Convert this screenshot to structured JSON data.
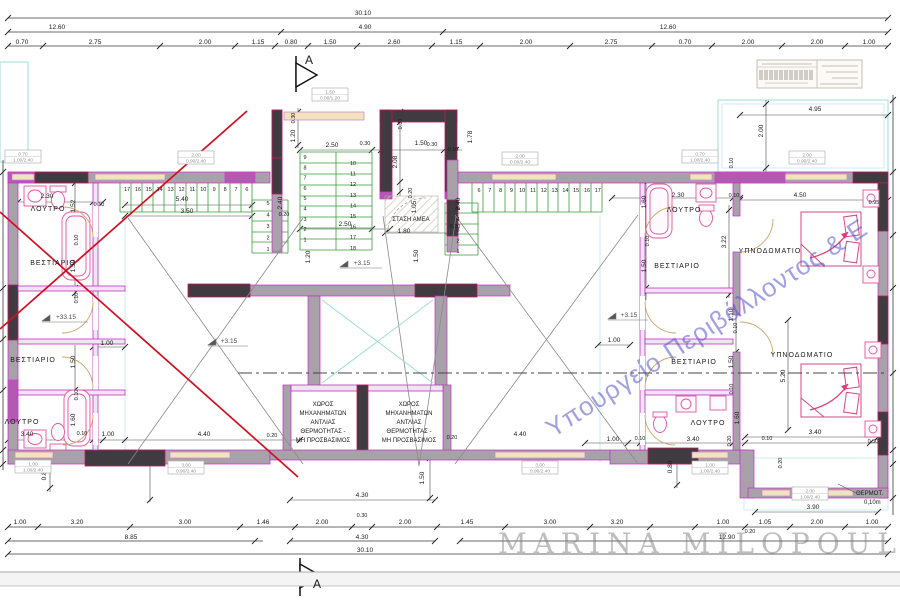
{
  "title": "Architectural floor plan",
  "watermarks": {
    "ministry": "Υπουργείο Περιβάλλοντος & Ε",
    "author": "MARINA MILOPOULOU"
  },
  "section_marker_letter": "A",
  "colors": {
    "wall_magenta": "#c92ac9",
    "wall_dark": "#3f3b40",
    "stair_green": "#3a9e3a",
    "revision_red": "#d40f1f",
    "balcony_cyan": "#9fdbdb",
    "window_tan": "#f3e2c0",
    "fixture_pink": "#e0559f",
    "watermark_blue": "#5252d0"
  },
  "labels": [
    {
      "n": "dim-overall-top",
      "t": "30.10",
      "x": 363,
      "y": 15
    },
    {
      "n": "dim-label",
      "t": "12.60",
      "x": 57,
      "y": 29
    },
    {
      "n": "dim-label",
      "t": "4.90",
      "x": 365,
      "y": 29
    },
    {
      "n": "dim-label",
      "t": "12.60",
      "x": 668,
      "y": 29
    },
    {
      "n": "dim-label",
      "t": "0.70",
      "x": 22,
      "y": 44
    },
    {
      "n": "dim-label",
      "t": "2.75",
      "x": 95,
      "y": 44
    },
    {
      "n": "dim-label",
      "t": "2.00",
      "x": 205,
      "y": 44
    },
    {
      "n": "dim-label",
      "t": "1.15",
      "x": 258,
      "y": 44
    },
    {
      "n": "dim-label",
      "t": "0.80",
      "x": 291,
      "y": 44
    },
    {
      "n": "dim-label",
      "t": "1.50",
      "x": 330,
      "y": 44
    },
    {
      "n": "dim-label",
      "t": "2.60",
      "x": 394,
      "y": 44
    },
    {
      "n": "dim-label",
      "t": "1.15",
      "x": 456,
      "y": 44
    },
    {
      "n": "dim-label",
      "t": "2.00",
      "x": 526,
      "y": 44
    },
    {
      "n": "dim-label",
      "t": "2.75",
      "x": 611,
      "y": 44
    },
    {
      "n": "dim-label",
      "t": "0.70",
      "x": 685,
      "y": 44
    },
    {
      "n": "dim-label",
      "t": "2.00",
      "x": 748,
      "y": 44
    },
    {
      "n": "dim-label",
      "t": "2.00",
      "x": 817,
      "y": 44
    },
    {
      "n": "dim-label",
      "t": "1.00",
      "x": 869,
      "y": 44
    },
    {
      "n": "dim-label",
      "t": "1.00",
      "x": 20,
      "y": 524
    },
    {
      "n": "dim-label",
      "t": "3.20",
      "x": 77,
      "y": 524
    },
    {
      "n": "dim-label",
      "t": "3.00",
      "x": 185,
      "y": 524
    },
    {
      "n": "dim-label",
      "t": "1.46",
      "x": 263,
      "y": 524
    },
    {
      "n": "dim-label",
      "t": "2.00",
      "x": 322,
      "y": 524
    },
    {
      "n": "dim-label",
      "t": "0.30",
      "x": 362,
      "y": 517,
      "s": 5.5
    },
    {
      "n": "dim-label",
      "t": "2.00",
      "x": 405,
      "y": 524
    },
    {
      "n": "dim-label",
      "t": "1.45",
      "x": 467,
      "y": 524
    },
    {
      "n": "dim-label",
      "t": "3.00",
      "x": 550,
      "y": 524
    },
    {
      "n": "dim-label",
      "t": "3.20",
      "x": 617,
      "y": 524
    },
    {
      "n": "dim-label",
      "t": "1.00",
      "x": 723,
      "y": 524
    },
    {
      "n": "dim-label",
      "t": "1.05",
      "x": 765,
      "y": 524
    },
    {
      "n": "dim-label",
      "t": "0.20",
      "x": 750,
      "y": 533,
      "s": 5.5
    },
    {
      "n": "dim-label",
      "t": "2.00",
      "x": 817,
      "y": 524
    },
    {
      "n": "dim-label",
      "t": "1.00",
      "x": 872,
      "y": 524
    },
    {
      "n": "dim-label",
      "t": "8.85",
      "x": 131,
      "y": 539
    },
    {
      "n": "dim-label",
      "t": "4.30",
      "x": 362,
      "y": 539
    },
    {
      "n": "dim-label",
      "t": "12.90",
      "x": 727,
      "y": 539
    },
    {
      "n": "dim-overall-bottom",
      "t": "30.10",
      "x": 365,
      "y": 552
    },
    {
      "n": "dim-label",
      "t": "4.30",
      "x": 362,
      "y": 497
    },
    {
      "n": "dim-label",
      "t": "3.90",
      "x": 813,
      "y": 509
    },
    {
      "n": "dim-label",
      "t": "1.50",
      "x": 424,
      "y": 478,
      "r": -90
    },
    {
      "n": "dim-label",
      "t": "3.40",
      "x": 27,
      "y": 436
    },
    {
      "n": "dim-label",
      "t": "0.10",
      "x": 82,
      "y": 435,
      "s": 5.5
    },
    {
      "n": "dim-label",
      "t": "1.00",
      "x": 108,
      "y": 436
    },
    {
      "n": "dim-label",
      "t": "4.40",
      "x": 204,
      "y": 436
    },
    {
      "n": "dim-label",
      "t": "0.20",
      "x": 272,
      "y": 437,
      "s": 5.5
    },
    {
      "n": "dim-label",
      "t": "0.20",
      "x": 452,
      "y": 439,
      "s": 5.5
    },
    {
      "n": "dim-label",
      "t": "4.40",
      "x": 520,
      "y": 436
    },
    {
      "n": "dim-label",
      "t": "1.00",
      "x": 613,
      "y": 441
    },
    {
      "n": "dim-label",
      "t": "0.10",
      "x": 640,
      "y": 440,
      "s": 5.5
    },
    {
      "n": "dim-label",
      "t": "3.40",
      "x": 693,
      "y": 441
    },
    {
      "n": "dim-label",
      "t": "0.10",
      "x": 767,
      "y": 440,
      "s": 5.5
    },
    {
      "n": "dim-label",
      "t": "3.40",
      "x": 815,
      "y": 434
    },
    {
      "n": "dim-label",
      "t": "0.30",
      "x": 873,
      "y": 443,
      "s": 5.5
    },
    {
      "n": "dim-label",
      "t": "0.80",
      "x": 46,
      "y": 474,
      "r": -90
    },
    {
      "n": "dim-label",
      "t": "0.80",
      "x": 672,
      "y": 467,
      "r": -90
    },
    {
      "n": "dim-label",
      "t": "0.20",
      "x": 782,
      "y": 463,
      "r": -90,
      "s": 5.5
    },
    {
      "n": "dim-label",
      "t": "2.30",
      "x": 47,
      "y": 198
    },
    {
      "n": "dim-label",
      "t": "0.10",
      "x": 99,
      "y": 206,
      "s": 5.5
    },
    {
      "n": "dim-label",
      "t": "1.52",
      "x": 75,
      "y": 206,
      "r": -90
    },
    {
      "n": "dim-label",
      "t": "0.10",
      "x": 78,
      "y": 240,
      "r": -90,
      "s": 5.5
    },
    {
      "n": "dim-label",
      "t": "1.50",
      "x": 75,
      "y": 266,
      "r": -90
    },
    {
      "n": "dim-label",
      "t": "0.10",
      "x": 78,
      "y": 298,
      "r": -90,
      "s": 5.5
    },
    {
      "n": "dim-label",
      "t": "1.50",
      "x": 75,
      "y": 362,
      "r": -90
    },
    {
      "n": "dim-label",
      "t": "0.10",
      "x": 78,
      "y": 395,
      "r": -90,
      "s": 5.5
    },
    {
      "n": "dim-label",
      "t": "1.60",
      "x": 75,
      "y": 420,
      "r": -90
    },
    {
      "n": "dim-label",
      "t": "1.00",
      "x": 107,
      "y": 345
    },
    {
      "n": "dim-label",
      "t": "2.30",
      "x": 678,
      "y": 197
    },
    {
      "n": "dim-label",
      "t": "0.10",
      "x": 734,
      "y": 197,
      "s": 5.5
    },
    {
      "n": "dim-label",
      "t": "4.50",
      "x": 800,
      "y": 197
    },
    {
      "n": "dim-label",
      "t": "0.95",
      "x": 874,
      "y": 204,
      "s": 5.5
    },
    {
      "n": "dim-label",
      "t": "1.60",
      "x": 646,
      "y": 202,
      "r": -90
    },
    {
      "n": "dim-label",
      "t": "0.10",
      "x": 649,
      "y": 241,
      "r": -90,
      "s": 5.5
    },
    {
      "n": "dim-label",
      "t": "1.50",
      "x": 646,
      "y": 266,
      "r": -90
    },
    {
      "n": "dim-label",
      "t": "3.22",
      "x": 726,
      "y": 242,
      "r": -90
    },
    {
      "n": "dim-label",
      "t": "0.10",
      "x": 733,
      "y": 163,
      "r": -90,
      "s": 5.5
    },
    {
      "n": "dim-label",
      "t": "1.10",
      "x": 733,
      "y": 315,
      "r": -90
    },
    {
      "n": "dim-label",
      "t": "0.10",
      "x": 737,
      "y": 328,
      "r": -90,
      "s": 5.5
    },
    {
      "n": "dim-label",
      "t": "1.50",
      "x": 733,
      "y": 362,
      "r": -90
    },
    {
      "n": "dim-label",
      "t": "0.10",
      "x": 733,
      "y": 389,
      "r": -90,
      "s": 5.5
    },
    {
      "n": "dim-label",
      "t": "1.60",
      "x": 739,
      "y": 418,
      "r": -90
    },
    {
      "n": "dim-label",
      "t": "0.20",
      "x": 731,
      "y": 441,
      "r": -90,
      "s": 5.5
    },
    {
      "n": "dim-label",
      "t": "5.20",
      "x": 785,
      "y": 376,
      "r": -90
    },
    {
      "n": "dim-label",
      "t": "2.00",
      "x": 763,
      "y": 131,
      "r": -90
    },
    {
      "n": "dim-label",
      "t": "1.78",
      "x": 472,
      "y": 137,
      "r": -90
    },
    {
      "n": "dim-label",
      "t": "1.00",
      "x": 614,
      "y": 342
    },
    {
      "n": "dim-label",
      "t": "4.95",
      "x": 815,
      "y": 111
    },
    {
      "n": "dim-label",
      "t": "2.50",
      "x": 332,
      "y": 147
    },
    {
      "n": "dim-label",
      "t": "0.30",
      "x": 365,
      "y": 145,
      "s": 5.5
    },
    {
      "n": "dim-label",
      "t": "1.50",
      "x": 421,
      "y": 145
    },
    {
      "n": "dim-label",
      "t": "0.30",
      "x": 432,
      "y": 146,
      "s": 5.5
    },
    {
      "n": "dim-label",
      "t": "0.10",
      "x": 453,
      "y": 151,
      "s": 5.5
    },
    {
      "n": "dim-label",
      "t": "2.08",
      "x": 397,
      "y": 162,
      "r": -90
    },
    {
      "n": "dim-label",
      "t": "0.30",
      "x": 402,
      "y": 124,
      "r": -90,
      "s": 5.5
    },
    {
      "n": "dim-label",
      "t": "0.30",
      "x": 295,
      "y": 118,
      "r": -90,
      "s": 5.5
    },
    {
      "n": "dim-label",
      "t": "1.20",
      "x": 295,
      "y": 136,
      "r": -90
    },
    {
      "n": "dim-label",
      "t": "0.20",
      "x": 412,
      "y": 193,
      "r": -90,
      "s": 5.5
    },
    {
      "n": "dim-label",
      "t": "1.05",
      "x": 416,
      "y": 207,
      "r": -90
    },
    {
      "n": "dim-label",
      "t": "1.50",
      "x": 418,
      "y": 256,
      "r": -90
    },
    {
      "n": "dim-label",
      "t": "1.20",
      "x": 310,
      "y": 257,
      "r": -90
    },
    {
      "n": "dim-label",
      "t": "2.40",
      "x": 282,
      "y": 203,
      "r": -90
    },
    {
      "n": "dim-label",
      "t": "2.40",
      "x": 460,
      "y": 204,
      "r": -90
    },
    {
      "n": "dim-label",
      "t": "2.50",
      "x": 345,
      "y": 226
    },
    {
      "n": "dim-label",
      "t": "1.80",
      "x": 404,
      "y": 233
    },
    {
      "n": "dim-label",
      "t": "5.40",
      "x": 182,
      "y": 201
    },
    {
      "n": "dim-label",
      "t": "3.50",
      "x": 187,
      "y": 213
    },
    {
      "n": "dim-label",
      "t": "0.20",
      "x": 284,
      "y": 216,
      "s": 5.5
    },
    {
      "n": "dim-label",
      "t": "0.20",
      "x": 455,
      "y": 228,
      "s": 5.5
    },
    {
      "n": "amea-stop-label",
      "t": "ΣΤΑΣΗ ΑΜΕΑ",
      "x": 411,
      "y": 221,
      "s": 6
    },
    {
      "n": "elevation-label",
      "t": "+3.15",
      "x": 362,
      "y": 265,
      "c": "#4a4a4a"
    },
    {
      "n": "elevation-label",
      "t": "+3.15",
      "x": 229,
      "y": 343,
      "c": "#4a4a4a"
    },
    {
      "n": "elevation-label",
      "t": "+3.15",
      "x": 629,
      "y": 317,
      "c": "#4a4a4a"
    },
    {
      "n": "elevation-label",
      "t": "+33.15",
      "x": 66,
      "y": 319,
      "c": "#4a4a4a"
    },
    {
      "n": "room-label",
      "t": "ΛΟΥΤΡΟ",
      "x": 48,
      "y": 211,
      "s": 7,
      "ls": 1
    },
    {
      "n": "room-label",
      "t": "ΒΕΣΤΙΑΡΙΟ",
      "x": 53,
      "y": 265,
      "s": 7,
      "ls": 1
    },
    {
      "n": "room-label",
      "t": "ΒΕΣΤΙΑΡΙΟ",
      "x": 33,
      "y": 362,
      "s": 7,
      "ls": 1
    },
    {
      "n": "room-label",
      "t": "ΛΟΥΤΡΟ",
      "x": 22,
      "y": 424,
      "s": 7,
      "ls": 1
    },
    {
      "n": "room-label",
      "t": "ΛΟΥΤΡΟ",
      "x": 684,
      "y": 212,
      "s": 7,
      "ls": 1
    },
    {
      "n": "room-label",
      "t": "ΒΕΣΤΙΑΡΙΟ",
      "x": 677,
      "y": 268,
      "s": 7,
      "ls": 1
    },
    {
      "n": "room-label",
      "t": "ΒΕΣΤΙΑΡΙΟ",
      "x": 694,
      "y": 364,
      "s": 7,
      "ls": 1
    },
    {
      "n": "room-label",
      "t": "ΛΟΥΤΡΟ",
      "x": 708,
      "y": 425,
      "s": 7,
      "ls": 1
    },
    {
      "n": "room-label",
      "t": "ΥΠΝΟΔΩΜΑΤΙΟ",
      "x": 770,
      "y": 253,
      "s": 7,
      "ls": 1
    },
    {
      "n": "room-label",
      "t": "ΥΠΝΟΔΩΜΑΤΙΟ",
      "x": 802,
      "y": 357,
      "s": 7,
      "ls": 1
    },
    {
      "n": "machine-room-label",
      "t": "ΧΩΡΟΣ",
      "x": 323,
      "y": 406,
      "s": 6
    },
    {
      "n": "machine-room-label",
      "t": "ΜΗΧΑΝΗΜΑΤΩΝ",
      "x": 323,
      "y": 415,
      "s": 6
    },
    {
      "n": "machine-room-label",
      "t": "ΑΝΤΛΙΑΣ",
      "x": 323,
      "y": 424,
      "s": 6
    },
    {
      "n": "machine-room-label",
      "t": "ΘΕΡΜΟΤΗΤΑΣ -",
      "x": 323,
      "y": 433,
      "s": 6
    },
    {
      "n": "machine-room-label",
      "t": "ΜΗ ΠΡΟΣΒΑΣΙΜΟΣ",
      "x": 323,
      "y": 442,
      "s": 6
    },
    {
      "n": "machine-room-label",
      "t": "ΧΩΡΟΣ",
      "x": 409,
      "y": 406,
      "s": 6
    },
    {
      "n": "machine-room-label",
      "t": "ΜΗΧΑΝΗΜΑΤΩΝ",
      "x": 409,
      "y": 415,
      "s": 6
    },
    {
      "n": "machine-room-label",
      "t": "ΑΝΤΛΙΑΣ",
      "x": 409,
      "y": 424,
      "s": 6
    },
    {
      "n": "machine-room-label",
      "t": "ΘΕΡΜΟΤΗΤΑΣ -",
      "x": 409,
      "y": 433,
      "s": 6
    },
    {
      "n": "machine-room-label",
      "t": "ΜΗ ΠΡΟΣΒΑΣΙΜΟΣ",
      "x": 409,
      "y": 442,
      "s": 6
    },
    {
      "n": "insulation-callout",
      "t": "ΘΕΡΜΟΤ.",
      "x": 856,
      "y": 495,
      "a": "start",
      "s": 6
    },
    {
      "n": "insulation-callout",
      "t": "0,10m",
      "x": 864,
      "y": 504,
      "a": "start",
      "s": 6
    },
    {
      "n": "section-letter",
      "t": "A",
      "x": 309,
      "y": 64,
      "s": 12
    },
    {
      "n": "section-letter",
      "t": "A",
      "x": 317,
      "y": 588,
      "s": 12
    }
  ],
  "stairs": [
    {
      "x": 127,
      "y": 191,
      "dx": 10.9,
      "dy": 0,
      "nums": [
        "17",
        "16",
        "15",
        "14",
        "13",
        "12",
        "11",
        "10",
        "9",
        "8",
        "7",
        "6"
      ]
    },
    {
      "x": 268,
      "y": 205,
      "dx": 0,
      "dy": 11.5,
      "nums": [
        "5",
        "4",
        "3",
        "2",
        "1"
      ]
    },
    {
      "x": 305,
      "y": 159,
      "dx": 0,
      "dy": 10.3,
      "nums": [
        "9",
        "8",
        "7",
        "6",
        "5",
        "4",
        "3",
        "2",
        "1"
      ]
    },
    {
      "x": 353,
      "y": 165,
      "dx": 0,
      "dy": 10.6,
      "nums": [
        "10",
        "11",
        "12",
        "13",
        "14",
        "15",
        "16",
        "17",
        "18"
      ]
    },
    {
      "x": 479,
      "y": 192,
      "dx": 10.8,
      "dy": 0,
      "nums": [
        "6",
        "7",
        "8",
        "9",
        "10",
        "11",
        "12",
        "13",
        "14",
        "15",
        "16",
        "17"
      ]
    },
    {
      "x": 458,
      "y": 210,
      "dx": 0,
      "dy": 10.8,
      "nums": [
        "5",
        "4",
        "3",
        "2",
        "1"
      ]
    }
  ],
  "schedule_boxes": [
    {
      "cx": 23,
      "ty": 150,
      "l1": "0.70",
      "l2": "1.00/2.40"
    },
    {
      "cx": 196,
      "ty": 151,
      "l1": "2.00",
      "l2": "0.90/2.40"
    },
    {
      "cx": 330,
      "ty": 88,
      "l1": "1.50",
      "l2": "0.00/1.20"
    },
    {
      "cx": 520,
      "ty": 152,
      "l1": "2.00",
      "l2": "0.00/2.40"
    },
    {
      "cx": 700,
      "ty": 150,
      "l1": "0.70",
      "l2": "1.00/2.40"
    },
    {
      "cx": 807,
      "ty": 151,
      "l1": "2.00",
      "l2": "0.90/2.40"
    },
    {
      "cx": 33,
      "ty": 460,
      "l1": "1.00",
      "l2": "1.00/2.40"
    },
    {
      "cx": 186,
      "ty": 461,
      "l1": "3.00",
      "l2": "0.90/2.40"
    },
    {
      "cx": 540,
      "ty": 461,
      "l1": "3.00",
      "l2": "0.90/2.40"
    },
    {
      "cx": 710,
      "ty": 461,
      "l1": "1.00",
      "l2": "1.00/2.40"
    },
    {
      "cx": 810,
      "ty": 487,
      "l1": "2.00",
      "l2": "1.00/2.40"
    }
  ]
}
